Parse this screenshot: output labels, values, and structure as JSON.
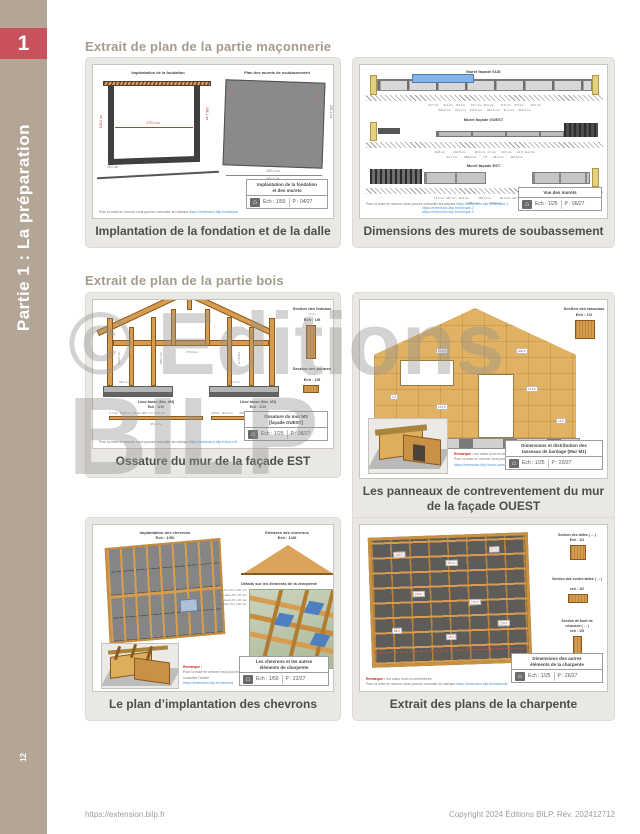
{
  "sidebar": {
    "chapter_number": "1",
    "title": "Partie 1 : La préparation",
    "page_number": "12"
  },
  "headings": {
    "masonry": "Extrait de plan de la partie maçonnerie",
    "wood": "Extrait de plan de la partie bois"
  },
  "watermark": {
    "line1": "© Editions",
    "line2": "BILP"
  },
  "footer": {
    "url": "https://extension.bilp.fr",
    "copyright": "Copyright 2024 Éditions BILP. Rév. 202412712"
  },
  "cards": [
    {
      "caption": "Implantation de la fondation et de la dalle",
      "left_title": "Implantation de la fondation",
      "right_title": "Plan des murets de soubassement",
      "dims_left": {
        "height_l": "198,1 cm",
        "width": "370,0 cm",
        "height_r": "198,1 cm",
        "offset": "15,0 cm"
      },
      "dims_right": {
        "inner_l": "400,0",
        "inner_r": "265,5",
        "width1": "355,1 cm",
        "width2": "360,0 cm",
        "height": "236,1 cm"
      },
      "note": "Pour la mise en oeuvre vous pouvez consulter la rubrique",
      "note_link": "https://extension.bilp.fr/rubrique",
      "titleblock": {
        "line1": "Implantation de la fondation",
        "line2": "et des murets",
        "ech": "Ech : 1/50",
        "page": "P : 04/27"
      }
    },
    {
      "caption": "Dimensions des murets de soubassement",
      "views": [
        {
          "title": "Muret façade SUD",
          "dims1": "13,7 cm      8,4 cm    8,8 cm       15,7 cm  13,5 cm         8,0 cm     8,5 cm        13,7 cm",
          "dims2": "322,0 cm     31,7 cm     313,0 cm      312,5 cm     31,7 cm     313,0 cm"
        },
        {
          "title": "Muret façade OUEST",
          "dims1": "13,8 cm          232,5 cm           16,3 cm  4,7 cm      10,5 cm      12,5  11,2 cm",
          "dims2": "32,7 cm        188,0 cm        7,5       45,2 cm        110,0 cm"
        },
        {
          "title": "Muret façade EST",
          "dims1": "11,6 cm  28,7 cm  12,6 cm           252,2 cm           28,4 cm  49,7 cm  18,5 cm",
          "dims2": "187,1 cm            318,0 cm"
        }
      ],
      "note": "Pour la mise en oeuvre vous pouvez consulter les articles",
      "note_links": [
        "https://extension.bilp.fr/rubrique-1",
        "https://extension.bilp.fr/rubrique-2",
        "https://extension.bilp.fr/rubrique-3"
      ],
      "titleblock": {
        "line1": "Vue des murets",
        "ech": "Ech : 1/25",
        "page": "P : 06/27"
      }
    },
    {
      "caption": "Ossature du mur de la façade EST",
      "section1_title": "Section des linteaux",
      "section1_sub": "( 1:1 )",
      "section1_ech": "Ech : 1/5",
      "section2_title": "Section des poutres",
      "section2_sub": "( ... )",
      "section2_ech": "Ech : 1/5",
      "lisse1_title": "Lisse basse (Mur_M3)",
      "lisse1_ech": "Ech : 1/10",
      "lisse1_dims": "4,7 cm  35,8 cm  4,5 cm 28,7 cm  54,0 cm",
      "lisse1_total": "95,0 cm",
      "lisse2_title": "Lisse basse (Mur_M3)",
      "lisse2_ech": "Ech : 1/10",
      "lisse2_dims": "4,5/10   35,0 cm        362,0",
      "lisse2_total": "143,0 cm",
      "frame_dims": [
        "230,5 cm",
        "175,0 cm",
        "198,1 cm",
        "128,8 cm",
        "58,5 cm",
        "50,9 cm"
      ],
      "note": "Pour la mise en oeuvre vous pouvez consulter la rubrique",
      "note_link": "https://extension.bilp.fr/mur-m3",
      "titleblock": {
        "line1": "Ossature du mur M3",
        "line2": "[façade OUEST]",
        "ech": "Ech : 1/25",
        "page": "P : 08/27"
      }
    },
    {
      "caption": "Les panneaux de contreventement du mur de la façade OUEST",
      "tasseaux_title": "Section des tasseaux",
      "tasseaux_ech": "Ech : 1/2",
      "panel_chips": [
        "174,0",
        "200,6",
        "7,5",
        "174,5",
        "12,5",
        "174,5"
      ],
      "remark_label": "Remarque :",
      "remark_text": "les cotes sont en centimètres.",
      "note": "Pour la mise en oeuvre vous pouvez consulter la rubrique",
      "note_link": "https://extension.bilp.fr/mur-ouest",
      "titleblock": {
        "line1": "Dimensions et distribution des",
        "line2": "tasseaux de bardage (Mur M1)",
        "ech": "Ech : 1/25",
        "page": "P : 20/27"
      }
    },
    {
      "caption": "Le plan d’implantation des chevrons",
      "plan_title": "Implantation des chevrons",
      "plan_ech": "Ech : 1/50",
      "gable_title": "Entraxes des chevrons",
      "gable_ech": "Ech : 1/40",
      "details_title": "Détails sur les éléments de la charpente",
      "element_labels": [
        "Chevron 45 x 220 mm",
        "Contre-latte 29 x 45 mm",
        "Liteau 29 x 40 mm",
        "Planche 45 x 120 mm"
      ],
      "element_labels2": [
        "Chevron 45 x 220 mm",
        "Planche de rive 29 x 180 mm",
        "Moignon 45 x 220 mm"
      ],
      "remark_label": "Remarque :",
      "remark_text": "les cotes sont en centimètres.",
      "note": "Pour la mise en oeuvre vous pouvez consulter l’article",
      "note_link": "https://extension.bilp.fr/chevrons",
      "titleblock": {
        "line1": "Les chevrons et les autres",
        "line2": "éléments de charpente",
        "ech": "Ech : 1/50",
        "page": "P : 22/27"
      }
    },
    {
      "caption": "Extrait des plans de la charpente",
      "lattes_title": "Section des lattes ( ... )",
      "lattes_ech": "Ech : 1/2",
      "contrelattes_title": "Section des contre-lattes ( ... )",
      "contrelattes_ech": "ech : 1/2",
      "rehausse_title": "Section de bout de",
      "rehausse_title2": "rehausse ( ... )",
      "rehausse_ech": "ech : 1/5",
      "chips": [
        "130,5",
        "254,0",
        "57,5",
        "234,0",
        "175,2",
        "88,0",
        "45,2",
        "120,4"
      ],
      "remark_label": "Remarque :",
      "remark_text": "les cotes sont en centimètres.",
      "note": "Pour la mise en oeuvre vous pouvez consulter la rubrique",
      "note_link": "https://extension.bilp.fr/charpente",
      "titleblock": {
        "line1": "Dimensions des autres",
        "line2": "éléments de la charpente",
        "ech": "Ech : 1/25",
        "page": "P : 26/27"
      }
    }
  ]
}
